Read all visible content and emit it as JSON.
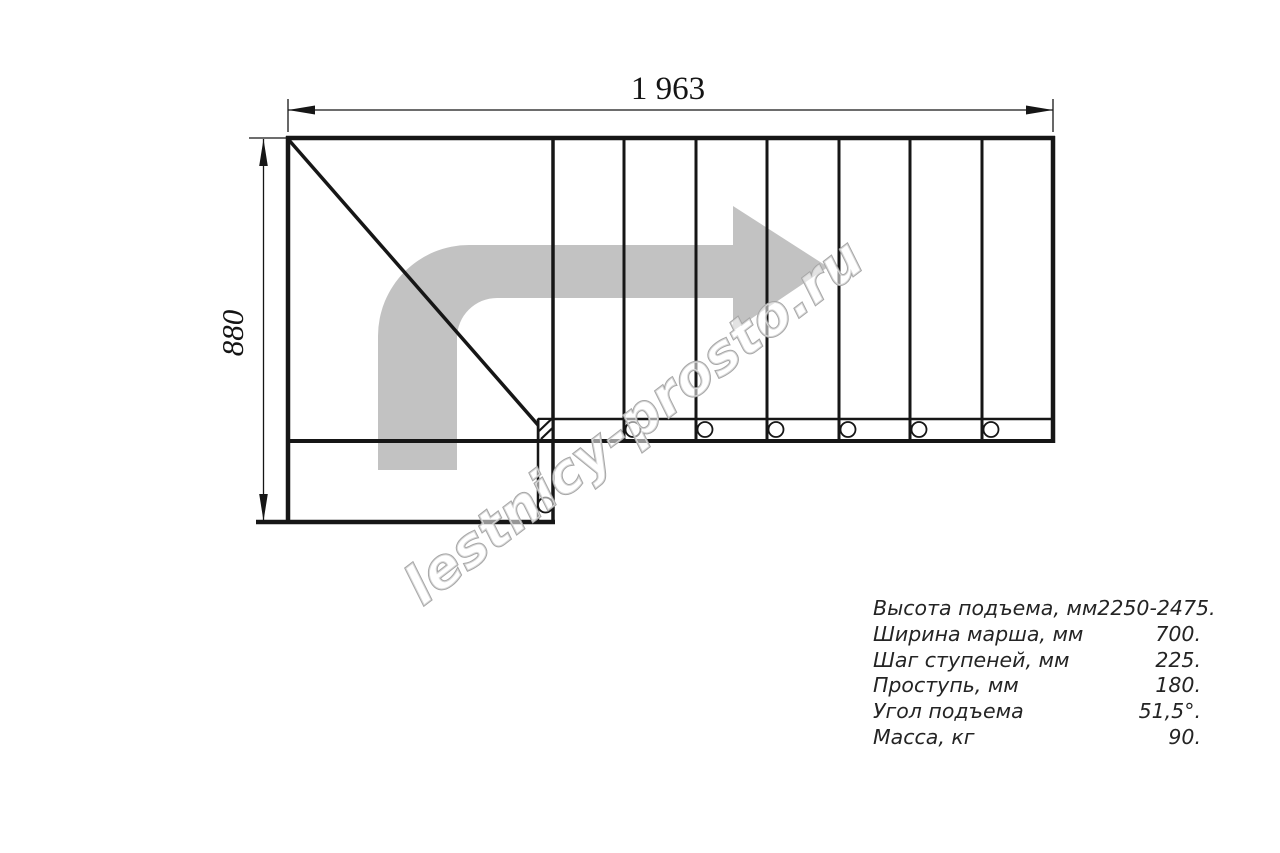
{
  "drawing": {
    "title": "staircase-plan",
    "dimensions": {
      "width_label": "1 963",
      "height_label": "880"
    },
    "stair": {
      "straight_treads": 7,
      "balusters": 6,
      "turn": "quarter-turn-left-landing"
    },
    "watermark": "lestnicy-prosto.ru",
    "specs": {
      "rows": [
        {
          "label": "Высота подъема, мм",
          "value": "2250-2475."
        },
        {
          "label": "Ширина марша, мм",
          "value": "700."
        },
        {
          "label": "Шаг ступеней, мм",
          "value": "225."
        },
        {
          "label": "Проступь, мм",
          "value": "180."
        },
        {
          "label": "Угол подъема",
          "value": "51,5°."
        },
        {
          "label": "Масса, кг",
          "value": "90."
        }
      ]
    },
    "colors": {
      "line": "#161616",
      "direction_arrow": "#c2c2c2",
      "watermark_outline": "#a6a6a6",
      "background": "#ffffff"
    }
  }
}
